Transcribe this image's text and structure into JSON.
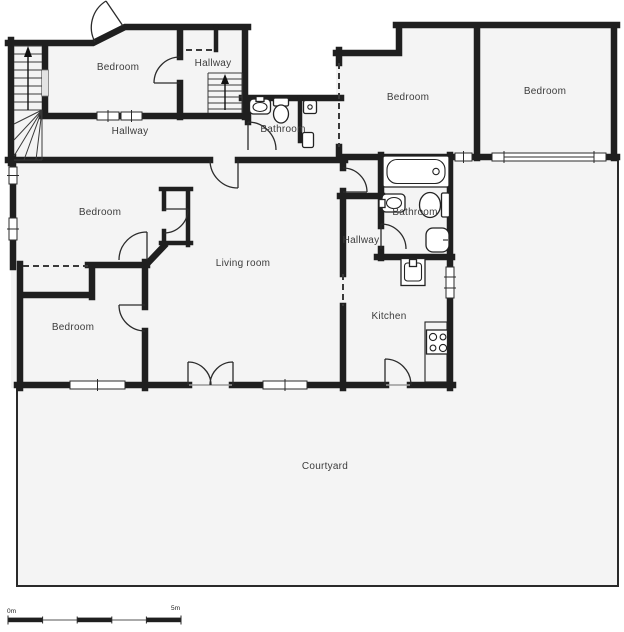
{
  "floorplan": {
    "labels": {
      "bedroom_top_left": "Bedroom",
      "hallway_top": "Hallway",
      "hallway_main": "Hallway",
      "bathroom_top": "Bathroom",
      "bedroom_top_right_inner": "Bedroom",
      "bedroom_top_right_outer": "Bedroom",
      "bedroom_mid_left": "Bedroom",
      "living_room": "Living room",
      "hallway_mid": "Hallway",
      "bathroom_mid": "Bathroom",
      "bedroom_bottom_left": "Bedroom",
      "kitchen": "Kitchen",
      "courtyard": "Courtyard"
    },
    "scale_bar": {
      "start_label": "0m",
      "end_label": "5m"
    },
    "colors": {
      "wall": "#1f1f1f",
      "room_fill": "#f4f4f4",
      "background": "#ffffff",
      "courtyard_border": "#2a2a2a"
    }
  }
}
